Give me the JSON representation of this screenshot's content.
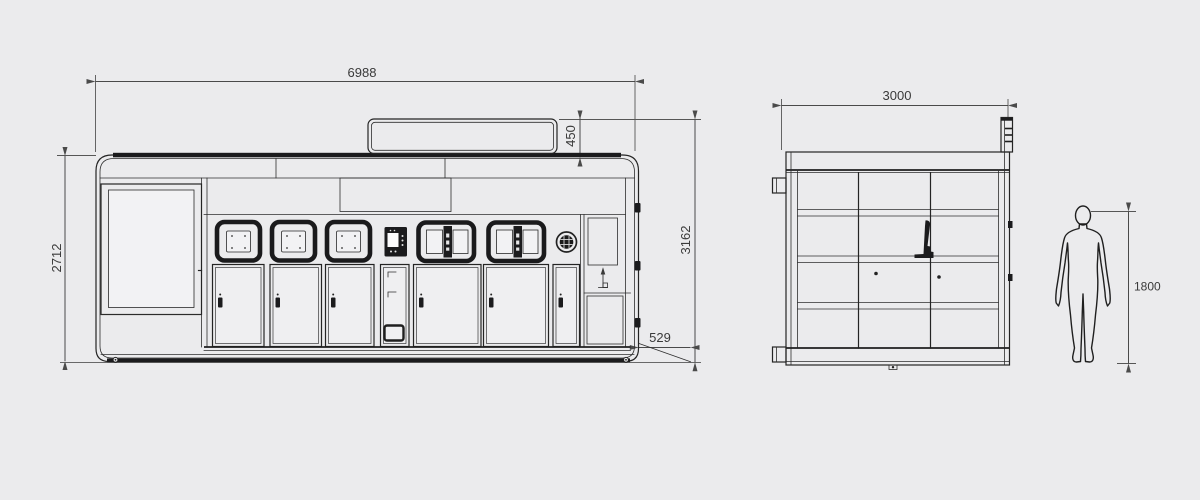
{
  "colors": {
    "background": "#ebebed",
    "line": "#242424",
    "frame_dark": "#1b1b1d",
    "dimension": "#3a3a3a"
  },
  "front_view": {
    "dim_overall_width": "6988",
    "dim_body_height": "2712",
    "dim_sign_height": "450",
    "dim_total_height": "3162",
    "dim_ramp_depth": "529"
  },
  "side_view": {
    "dim_depth": "3000"
  },
  "human_figure": {
    "dim_height": "1800"
  }
}
